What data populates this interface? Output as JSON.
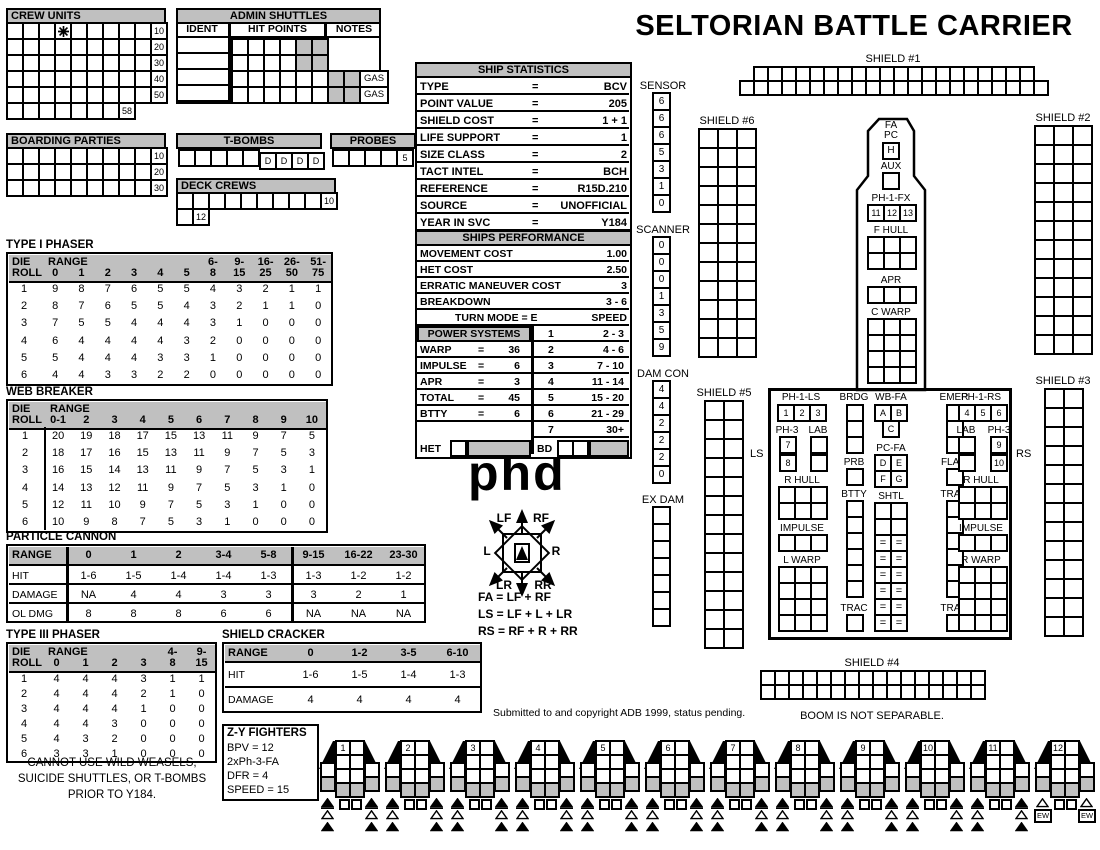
{
  "title": "SELTORIAN BATTLE CARRIER",
  "phd": "phd",
  "colors": {
    "gray": "#c0c0c0",
    "ink": "#000000",
    "paper": "#ffffff"
  },
  "notes": {
    "boom": "BOOM IS NOT SEPARABLE.",
    "copyright": "Submitted to and copyright ADB 1999, status pending.",
    "restriction_lines": [
      "CANNOT USE WILD WEASELS,",
      "SUICIDE SHUTTLES, OR T-BOMBS",
      "PRIOR TO Y184."
    ]
  },
  "crew_units": {
    "title": "CREW UNITS",
    "rows": [
      {
        "boxes": 9,
        "label": "10",
        "star_box": 4
      },
      {
        "boxes": 9,
        "label": "20"
      },
      {
        "boxes": 9,
        "label": "30"
      },
      {
        "boxes": 9,
        "label": "40"
      },
      {
        "boxes": 9,
        "label": "50"
      },
      {
        "boxes": 7,
        "label": "58"
      }
    ]
  },
  "admin_shuttles": {
    "title": "ADMIN SHUTTLES",
    "columns": [
      "IDENT",
      "HIT POINTS",
      "NOTES"
    ],
    "rows": [
      {
        "boxes": 6,
        "gray_last": 2,
        "note": ""
      },
      {
        "boxes": 6,
        "gray_last": 2,
        "note": ""
      },
      {
        "boxes": 8,
        "gray_last": 2,
        "note": "GAS"
      },
      {
        "boxes": 8,
        "gray_last": 2,
        "note": "GAS"
      }
    ]
  },
  "boarding_parties": {
    "title": "BOARDING PARTIES",
    "rows": [
      {
        "boxes": 9,
        "label": "10"
      },
      {
        "boxes": 9,
        "label": "20"
      },
      {
        "boxes": 9,
        "label": "30"
      }
    ]
  },
  "t_bombs": {
    "title": "T-BOMBS",
    "plain_boxes": 5,
    "d_boxes": 4,
    "d_label": "D"
  },
  "probes": {
    "title": "PROBES",
    "boxes": 4,
    "last_label": "5"
  },
  "deck_crews": {
    "title": "DECK CREWS",
    "row1": {
      "boxes": 9,
      "label": "10"
    },
    "row2": {
      "boxes": 1,
      "label": "12"
    }
  },
  "ship_statistics": {
    "title": "SHIP STATISTICS",
    "eq": "=",
    "rows": [
      [
        "TYPE",
        "BCV"
      ],
      [
        "POINT VALUE",
        "205"
      ],
      [
        "SHIELD COST",
        "1 + 1"
      ],
      [
        "LIFE SUPPORT",
        "1"
      ],
      [
        "SIZE CLASS",
        "2"
      ],
      [
        "TACT INTEL",
        "BCH"
      ],
      [
        "REFERENCE",
        "R15D.210"
      ],
      [
        "SOURCE",
        "UNOFFICIAL"
      ],
      [
        "YEAR IN SVC",
        "Y184"
      ]
    ]
  },
  "ships_performance": {
    "title": "SHIPS PERFORMANCE",
    "stats": [
      [
        "MOVEMENT COST",
        "1.00"
      ],
      [
        "HET COST",
        "2.50"
      ],
      [
        "ERRATIC MANEUVER COST",
        "3"
      ],
      [
        "BREAKDOWN",
        "3 - 6"
      ]
    ],
    "turn_mode": "TURN MODE = E",
    "speed_header": "SPEED",
    "power_title": "POWER SYSTEMS",
    "eq": "=",
    "power": [
      [
        "WARP",
        "36"
      ],
      [
        "IMPULSE",
        "6"
      ],
      [
        "APR",
        "3"
      ],
      [
        "TOTAL",
        "45"
      ],
      [
        "BTTY",
        "6"
      ]
    ],
    "speed_rows": [
      [
        "1",
        "2 - 3"
      ],
      [
        "2",
        "4 - 6"
      ],
      [
        "3",
        "7 - 10"
      ],
      [
        "4",
        "11 - 14"
      ],
      [
        "5",
        "15 - 20"
      ],
      [
        "6",
        "21 - 29"
      ],
      [
        "7",
        "30+"
      ]
    ],
    "het": "HET",
    "bd": "BD"
  },
  "type1_phaser": {
    "title": "TYPE I PHASER",
    "die_top": "DIE",
    "die_bot": "ROLL",
    "range_word": "RANGE",
    "cols_top": [
      "",
      "",
      "",
      "",
      "",
      "",
      "6-",
      "9-",
      "16-",
      "26-",
      "51-"
    ],
    "cols_bot": [
      "0",
      "1",
      "2",
      "3",
      "4",
      "5",
      "8",
      "15",
      "25",
      "50",
      "75"
    ],
    "dies": [
      "1",
      "2",
      "3",
      "4",
      "5",
      "6"
    ],
    "values": [
      [
        "9",
        "8",
        "7",
        "6",
        "5",
        "5",
        "4",
        "3",
        "2",
        "1",
        "1"
      ],
      [
        "8",
        "7",
        "6",
        "5",
        "5",
        "4",
        "3",
        "2",
        "1",
        "1",
        "0"
      ],
      [
        "7",
        "5",
        "5",
        "4",
        "4",
        "4",
        "3",
        "1",
        "0",
        "0",
        "0"
      ],
      [
        "6",
        "4",
        "4",
        "4",
        "4",
        "3",
        "2",
        "0",
        "0",
        "0",
        "0"
      ],
      [
        "5",
        "4",
        "4",
        "4",
        "3",
        "3",
        "1",
        "0",
        "0",
        "0",
        "0"
      ],
      [
        "4",
        "4",
        "3",
        "3",
        "2",
        "2",
        "0",
        "0",
        "0",
        "0",
        "0"
      ]
    ]
  },
  "web_breaker": {
    "title": "WEB BREAKER",
    "die_top": "DIE",
    "die_bot": "ROLL",
    "range_word": "RANGE",
    "cols_top": [
      "",
      "",
      "",
      "",
      "",
      "",
      "",
      "",
      "",
      ""
    ],
    "cols_bot": [
      "0-1",
      "2",
      "3",
      "4",
      "5",
      "6",
      "7",
      "8",
      "9",
      "10"
    ],
    "dies": [
      "1",
      "2",
      "3",
      "4",
      "5",
      "6"
    ],
    "values": [
      [
        "20",
        "19",
        "18",
        "17",
        "15",
        "13",
        "11",
        "9",
        "7",
        "5"
      ],
      [
        "18",
        "17",
        "16",
        "15",
        "13",
        "11",
        "9",
        "7",
        "5",
        "3"
      ],
      [
        "16",
        "15",
        "14",
        "13",
        "11",
        "9",
        "7",
        "5",
        "3",
        "1"
      ],
      [
        "14",
        "13",
        "12",
        "11",
        "9",
        "7",
        "5",
        "3",
        "1",
        "0"
      ],
      [
        "12",
        "11",
        "10",
        "9",
        "7",
        "5",
        "3",
        "1",
        "0",
        "0"
      ],
      [
        "10",
        "9",
        "8",
        "7",
        "5",
        "3",
        "1",
        "0",
        "0",
        "0"
      ]
    ]
  },
  "particle_cannon": {
    "title": "PARTICLE CANNON",
    "row_labels": [
      "RANGE",
      "HIT",
      "DAMAGE",
      "OL DMG"
    ],
    "ranges": [
      "0",
      "1",
      "2",
      "3-4",
      "5-8",
      "9-15",
      "16-22",
      "23-30"
    ],
    "hit": [
      "1-6",
      "1-5",
      "1-4",
      "1-4",
      "1-3",
      "1-3",
      "1-2",
      "1-2"
    ],
    "damage": [
      "NA",
      "4",
      "4",
      "3",
      "3",
      "3",
      "2",
      "1"
    ],
    "ol_dmg": [
      "8",
      "8",
      "8",
      "6",
      "6",
      "NA",
      "NA",
      "NA"
    ],
    "thick_divider_after_col": 5
  },
  "type3_phaser": {
    "title": "TYPE III PHASER",
    "die_top": "DIE",
    "die_bot": "ROLL",
    "range_word": "RANGE",
    "cols_top": [
      "",
      "",
      "",
      "",
      "4-",
      "9-"
    ],
    "cols_bot": [
      "0",
      "1",
      "2",
      "3",
      "8",
      "15"
    ],
    "dies": [
      "1",
      "2",
      "3",
      "4",
      "5",
      "6"
    ],
    "values": [
      [
        "4",
        "4",
        "4",
        "3",
        "1",
        "1"
      ],
      [
        "4",
        "4",
        "4",
        "2",
        "1",
        "0"
      ],
      [
        "4",
        "4",
        "4",
        "1",
        "0",
        "0"
      ],
      [
        "4",
        "4",
        "3",
        "0",
        "0",
        "0"
      ],
      [
        "4",
        "3",
        "2",
        "0",
        "0",
        "0"
      ],
      [
        "3",
        "3",
        "1",
        "0",
        "0",
        "0"
      ]
    ]
  },
  "shield_cracker": {
    "title": "SHIELD CRACKER",
    "row_labels": [
      "RANGE",
      "HIT",
      "DAMAGE"
    ],
    "ranges": [
      "0",
      "1-2",
      "3-5",
      "6-10"
    ],
    "hit": [
      "1-6",
      "1-5",
      "1-4",
      "1-3"
    ],
    "damage": [
      "4",
      "4",
      "4",
      "4"
    ]
  },
  "zy_fighters": {
    "title": "Z-Y FIGHTERS",
    "lines": [
      "BPV = 12",
      "2xPh-3-FA",
      "DFR = 4",
      "SPEED = 15"
    ]
  },
  "rose": {
    "lf": "LF",
    "rf": "RF",
    "l": "L",
    "r": "R",
    "lr": "LR",
    "rr": "RR"
  },
  "arc_formulas": [
    "FA = LF + RF",
    "LS = LF + L + LR",
    "RS = RF + R + RR"
  ],
  "tracks": {
    "sensor": {
      "label": "SENSOR",
      "values": [
        "6",
        "6",
        "6",
        "5",
        "3",
        "1",
        "0"
      ]
    },
    "scanner": {
      "label": "SCANNER",
      "values": [
        "0",
        "0",
        "0",
        "1",
        "3",
        "5",
        "9"
      ]
    },
    "dam_con": {
      "label": "DAM CON",
      "values": [
        "4",
        "4",
        "2",
        "2",
        "2",
        "0"
      ]
    },
    "ex_dam": {
      "label": "EX DAM",
      "boxes": 7
    }
  },
  "shields": {
    "s1": {
      "label": "SHIELD #1",
      "row_counts": [
        20,
        22
      ]
    },
    "s2": {
      "label": "SHIELD #2",
      "cols": 3,
      "rows": 12
    },
    "s3": {
      "label": "SHIELD #3",
      "cols": 2,
      "rows": 13
    },
    "s4": {
      "label": "SHIELD #4",
      "cols": 16,
      "rows": 2
    },
    "s5": {
      "label": "SHIELD #5",
      "cols": 2,
      "rows": 13
    },
    "s6": {
      "label": "SHIELD #6",
      "cols": 3,
      "rows": 12
    }
  },
  "boom": {
    "fa": "FA",
    "pc": "PC",
    "h": "H",
    "aux": "AUX",
    "ph1fx": {
      "label": "PH-1-FX",
      "boxes": [
        "11",
        "12",
        "13"
      ]
    },
    "f_hull": {
      "label": "F HULL",
      "cols": 3,
      "rows": 2
    },
    "apr": {
      "label": "APR",
      "cols": 3,
      "rows": 1
    },
    "c_warp": {
      "label": "C WARP",
      "cols": 3,
      "rows": 4
    }
  },
  "hull": {
    "ls": "LS",
    "rs": "RS",
    "ph1ls": {
      "label": "PH-1-LS",
      "boxes": [
        "1",
        "2",
        "3"
      ]
    },
    "brdg": {
      "label": "BRDG",
      "boxes": 3
    },
    "wb_fa": {
      "label": "WB-FA",
      "top": [
        "A",
        "B"
      ],
      "bottom": [
        "C"
      ]
    },
    "emer": {
      "label": "EMER",
      "boxes": 3
    },
    "ph1rs": {
      "label": "PH-1-RS",
      "boxes": [
        "4",
        "5",
        "6"
      ]
    },
    "ph3_l": {
      "label": "PH-3",
      "boxes": [
        "7",
        "8"
      ]
    },
    "lab_l": {
      "label": "LAB",
      "boxes": 2
    },
    "pc_fa": {
      "label": "PC-FA",
      "boxes": [
        "D",
        "E",
        "F",
        "G"
      ]
    },
    "lab_r": {
      "label": "LAB",
      "boxes": 2
    },
    "ph3_r": {
      "label": "PH-3",
      "boxes": [
        "9",
        "10"
      ]
    },
    "prb": {
      "label": "PRB"
    },
    "flag": {
      "label": "FLAG"
    },
    "r_hull_l": {
      "label": "R HULL",
      "cols": 3,
      "rows": 2
    },
    "r_hull_r": {
      "label": "R HULL",
      "cols": 3,
      "rows": 2
    },
    "btty": {
      "label": "BTTY",
      "boxes": 6
    },
    "shtl": {
      "label": "SHTL",
      "cols": 2,
      "rows": 8,
      "equals_rows": 6,
      "equals": "="
    },
    "tran": {
      "label": "TRAN",
      "boxes": 6
    },
    "trac_l": {
      "label": "TRAC"
    },
    "trac_r": {
      "label": "TRAC"
    },
    "impulse_l": {
      "label": "IMPULSE",
      "cols": 3,
      "rows": 1
    },
    "impulse_r": {
      "label": "IMPULSE",
      "cols": 3,
      "rows": 1
    },
    "l_warp": {
      "label": "L WARP",
      "cols": 3,
      "rows": 4
    },
    "r_warp": {
      "label": "R WARP",
      "cols": 3,
      "rows": 4
    }
  },
  "fighters": {
    "count": 12,
    "numbers": [
      "1",
      "2",
      "3",
      "4",
      "5",
      "6",
      "7",
      "8",
      "9",
      "10",
      "11",
      "12"
    ],
    "ew": "EW",
    "ready_squares": 2
  }
}
